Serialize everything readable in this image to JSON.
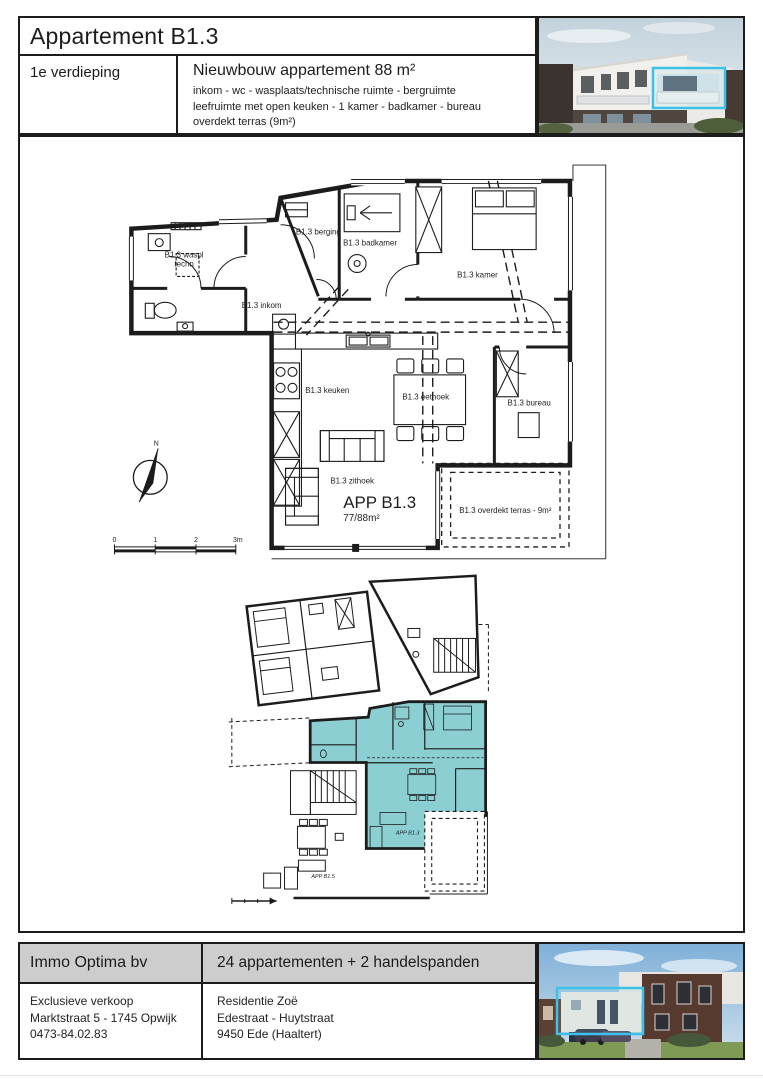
{
  "colors": {
    "line": "#1c1c1c",
    "band_gray": "#cdcdcd",
    "unit_teal": "#8ccfd3",
    "highlight_cyan": "#3ec1e8"
  },
  "header": {
    "title": "Appartement B1.3",
    "floor": "1e verdieping",
    "subtitle": "Nieuwbouw appartement 88 m²",
    "description_line1": "inkom - wc - wasplaats/technische ruimte - bergruimte",
    "description_line2": "leefruimte met open keuken - 1 kamer - badkamer - bureau",
    "description_line3": "overdekt terras (9m²)"
  },
  "floorplan": {
    "rooms": {
      "waspl_line1": "B1.3 waspl",
      "waspl_line2": "techn",
      "inkom": "B1.3 inkom",
      "berging": "B1.3 berging",
      "badkamer": "B1.3 badkamer",
      "kamer": "B1.3 kamer",
      "keuken": "B1.3 keuken",
      "eethoek": "B1.3 eethoek",
      "bureau": "B1.3 bureau",
      "zithoek": "B1.3 zithoek"
    },
    "apartment_label": "APP B1.3",
    "apartment_area": "77/88m²",
    "terras_label": "B1.3 overdekt terras - 9m²",
    "compass_north": "N",
    "scale_ticks": [
      "0",
      "1",
      "2",
      "3m"
    ]
  },
  "siteplan": {
    "unit_label": "APP B1.3",
    "neighbor_label": "APP B1.5"
  },
  "footer": {
    "company": "Immo Optima bv",
    "project": "24 appartementen + 2 handelspanden",
    "sales_line1": "Exclusieve verkoop",
    "sales_line2": "Marktstraat 5 - 1745 Opwijk",
    "sales_line3": "0473-84.02.83",
    "residence_line1": "Residentie Zoë",
    "residence_line2": "Edestraat - Huytstraat",
    "residence_line3": "9450 Ede (Haaltert)"
  }
}
